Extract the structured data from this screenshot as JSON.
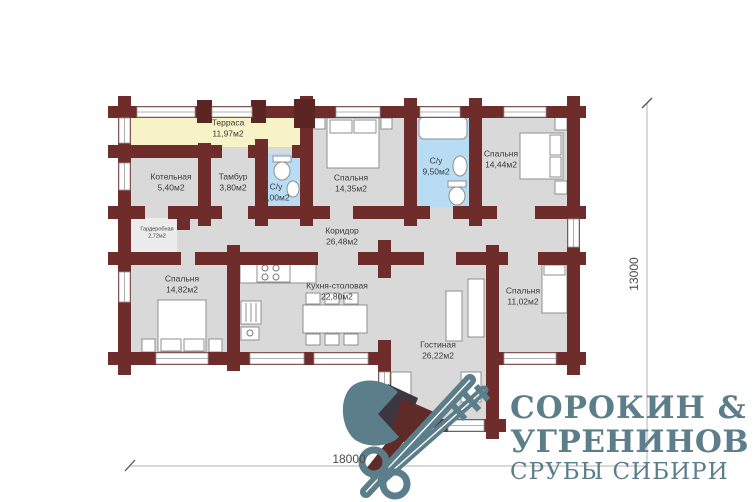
{
  "rooms": {
    "terrace": {
      "name": "Терраса",
      "area": "11,97м2"
    },
    "boiler": {
      "name": "Котельная",
      "area": "5,40м2"
    },
    "tambour": {
      "name": "Тамбур",
      "area": "3,80м2"
    },
    "wc_small": {
      "name": "С/у",
      "area": "3,00м2"
    },
    "bedroom_top_left": {
      "name": "Спальня",
      "area": "14,35м2"
    },
    "bathroom": {
      "name": "С/у",
      "area": "9,50м2"
    },
    "bedroom_top_right": {
      "name": "Спальня",
      "area": "14,44м2"
    },
    "corridor": {
      "name": "Коридор",
      "area": "26,48м2"
    },
    "wardrobe": {
      "name": "Гардеробная",
      "area": "2,72м2"
    },
    "bedroom_left": {
      "name": "Спальня",
      "area": "14,82м2"
    },
    "kitchen": {
      "name": "Кухня-столовая",
      "area": "22,80м2"
    },
    "living": {
      "name": "Гостиная",
      "area": "26,22м2"
    },
    "bedroom_right": {
      "name": "Спальня",
      "area": "11,02м2"
    }
  },
  "dimensions": {
    "width": "18000",
    "height": "13000"
  },
  "logo": {
    "line1": "СОРОКИН &",
    "line2": "УГРЕНИНОВ",
    "line3": "СРУБЫ СИБИРИ"
  },
  "colors": {
    "wall": "#6e2d2a",
    "wall_post": "#5b2521",
    "terrace_fill": "#f7f3c6",
    "wet_room_fill": "#b8dcf4",
    "floor_fill": "#d9d9d9",
    "logo_teal": "#5c7e8b",
    "logo_dark_red": "#5e2b28"
  }
}
